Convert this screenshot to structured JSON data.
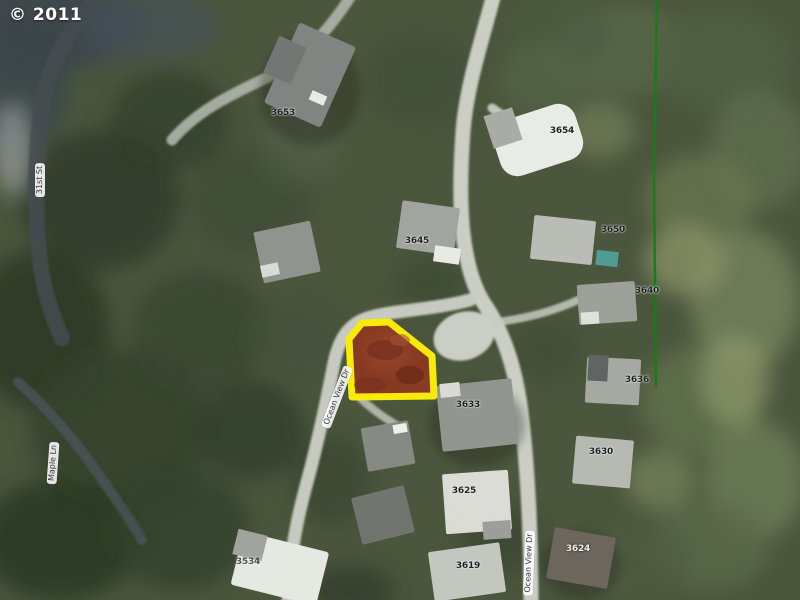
{
  "copyright": "© 2011",
  "map": {
    "street_labels": [
      {
        "name": "31st-st",
        "text": "31st St"
      },
      {
        "name": "maple-ln",
        "text": "Maple Ln"
      },
      {
        "name": "ocean-view-dr-west",
        "text": "Ocean View Dr"
      },
      {
        "name": "ocean-view-dr-south",
        "text": "Ocean View Dr"
      }
    ],
    "house_numbers": [
      {
        "text": "3653"
      },
      {
        "text": "3654"
      },
      {
        "text": "3645"
      },
      {
        "text": "3650"
      },
      {
        "text": "3640"
      },
      {
        "text": "3636"
      },
      {
        "text": "3633"
      },
      {
        "text": "3630"
      },
      {
        "text": "3625"
      },
      {
        "text": "3624"
      },
      {
        "text": "3619"
      },
      {
        "text": "3534"
      }
    ],
    "highlighted_parcel": {
      "street": "Ocean View Dr",
      "outline_color": "#f8ea0a",
      "fill_color": "#8a3a24"
    },
    "boundary_line_color": "#157a15"
  }
}
